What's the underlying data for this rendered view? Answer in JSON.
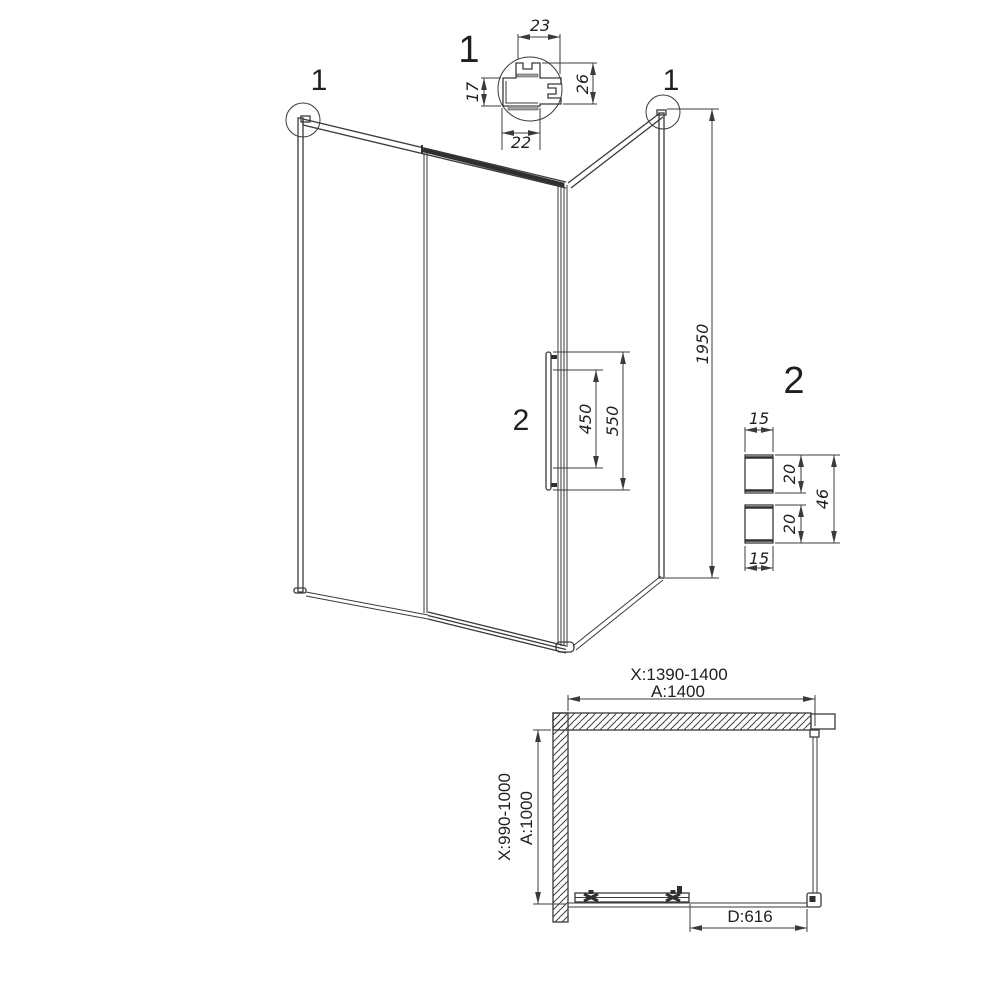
{
  "colors": {
    "line": "#3a3a3a",
    "dark": "#2f2f2f",
    "text": "#1f1f1f",
    "background": "#ffffff",
    "glass_gray": "#a0a0a0"
  },
  "iso": {
    "callout_left": "1",
    "callout_right": "1",
    "callout_handle": "2",
    "dim_height": "1950",
    "dim_handle_holes": "450",
    "dim_handle_length": "550"
  },
  "detail_profile": {
    "callout": "1",
    "dim_top": "23",
    "dim_left": "17",
    "dim_right": "26",
    "dim_bottom": "22"
  },
  "detail_wall_profiles": {
    "callout": "2",
    "dim_top_width": "15",
    "dim_upper_depth": "20",
    "dim_total_depth": "46",
    "dim_lower_depth": "20",
    "dim_bottom_width": "15"
  },
  "plan": {
    "dim_width_range": "X:1390-1400",
    "dim_width": "A:1400",
    "dim_depth_range": "X:990-1000",
    "dim_depth": "A:1000",
    "dim_door": "D:616"
  }
}
